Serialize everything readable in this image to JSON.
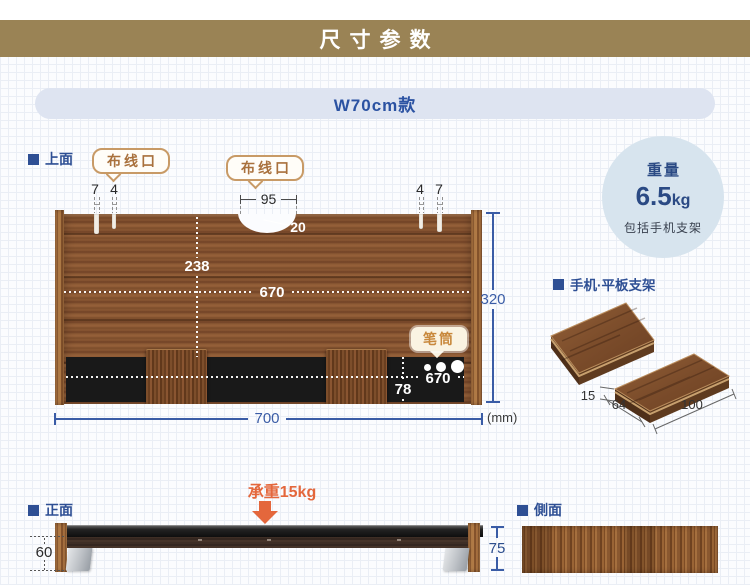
{
  "banner": {
    "title": "尺寸参数"
  },
  "model_pill": {
    "label": "W70cm款"
  },
  "sections": {
    "top_view": "上面",
    "front_view": "正面",
    "side_view": "側面",
    "stand": "手机·平板支架"
  },
  "callouts": {
    "cable_left": "布线口",
    "cable_right": "布线口",
    "pen_holder": "笔筒"
  },
  "weight_badge": {
    "title": "重量",
    "value": "6.5",
    "unit": "kg",
    "note": "包括手机支架"
  },
  "load_capacity": {
    "label": "承重15kg"
  },
  "unit_note": "(mm)",
  "dimensions": {
    "slot_left_a": "7",
    "slot_left_b": "4",
    "slot_right_a": "4",
    "slot_right_b": "7",
    "notch_width": "95",
    "notch_depth": "20",
    "board_depth_mid": "238",
    "board_inner_width": "670",
    "board_depth": "320",
    "board_width": "700",
    "tray_width": "670",
    "tray_depth": "78",
    "front_clearance": "60",
    "front_height": "75",
    "stand_thickness": "15",
    "stand_depth": "64",
    "stand_width": "100"
  },
  "colors": {
    "banner_bg": "#9a8355",
    "label_blue": "#2e4f94",
    "dim_blue": "#3a5ca6",
    "accent_orange": "#e4673c",
    "callout_border": "#c89a66",
    "callout_text": "#a9713d",
    "badge_bg": "#d7e4ee",
    "badge_text": "#2b4a84",
    "wood_brown": "#8c5a35",
    "tray_black": "#191919"
  }
}
